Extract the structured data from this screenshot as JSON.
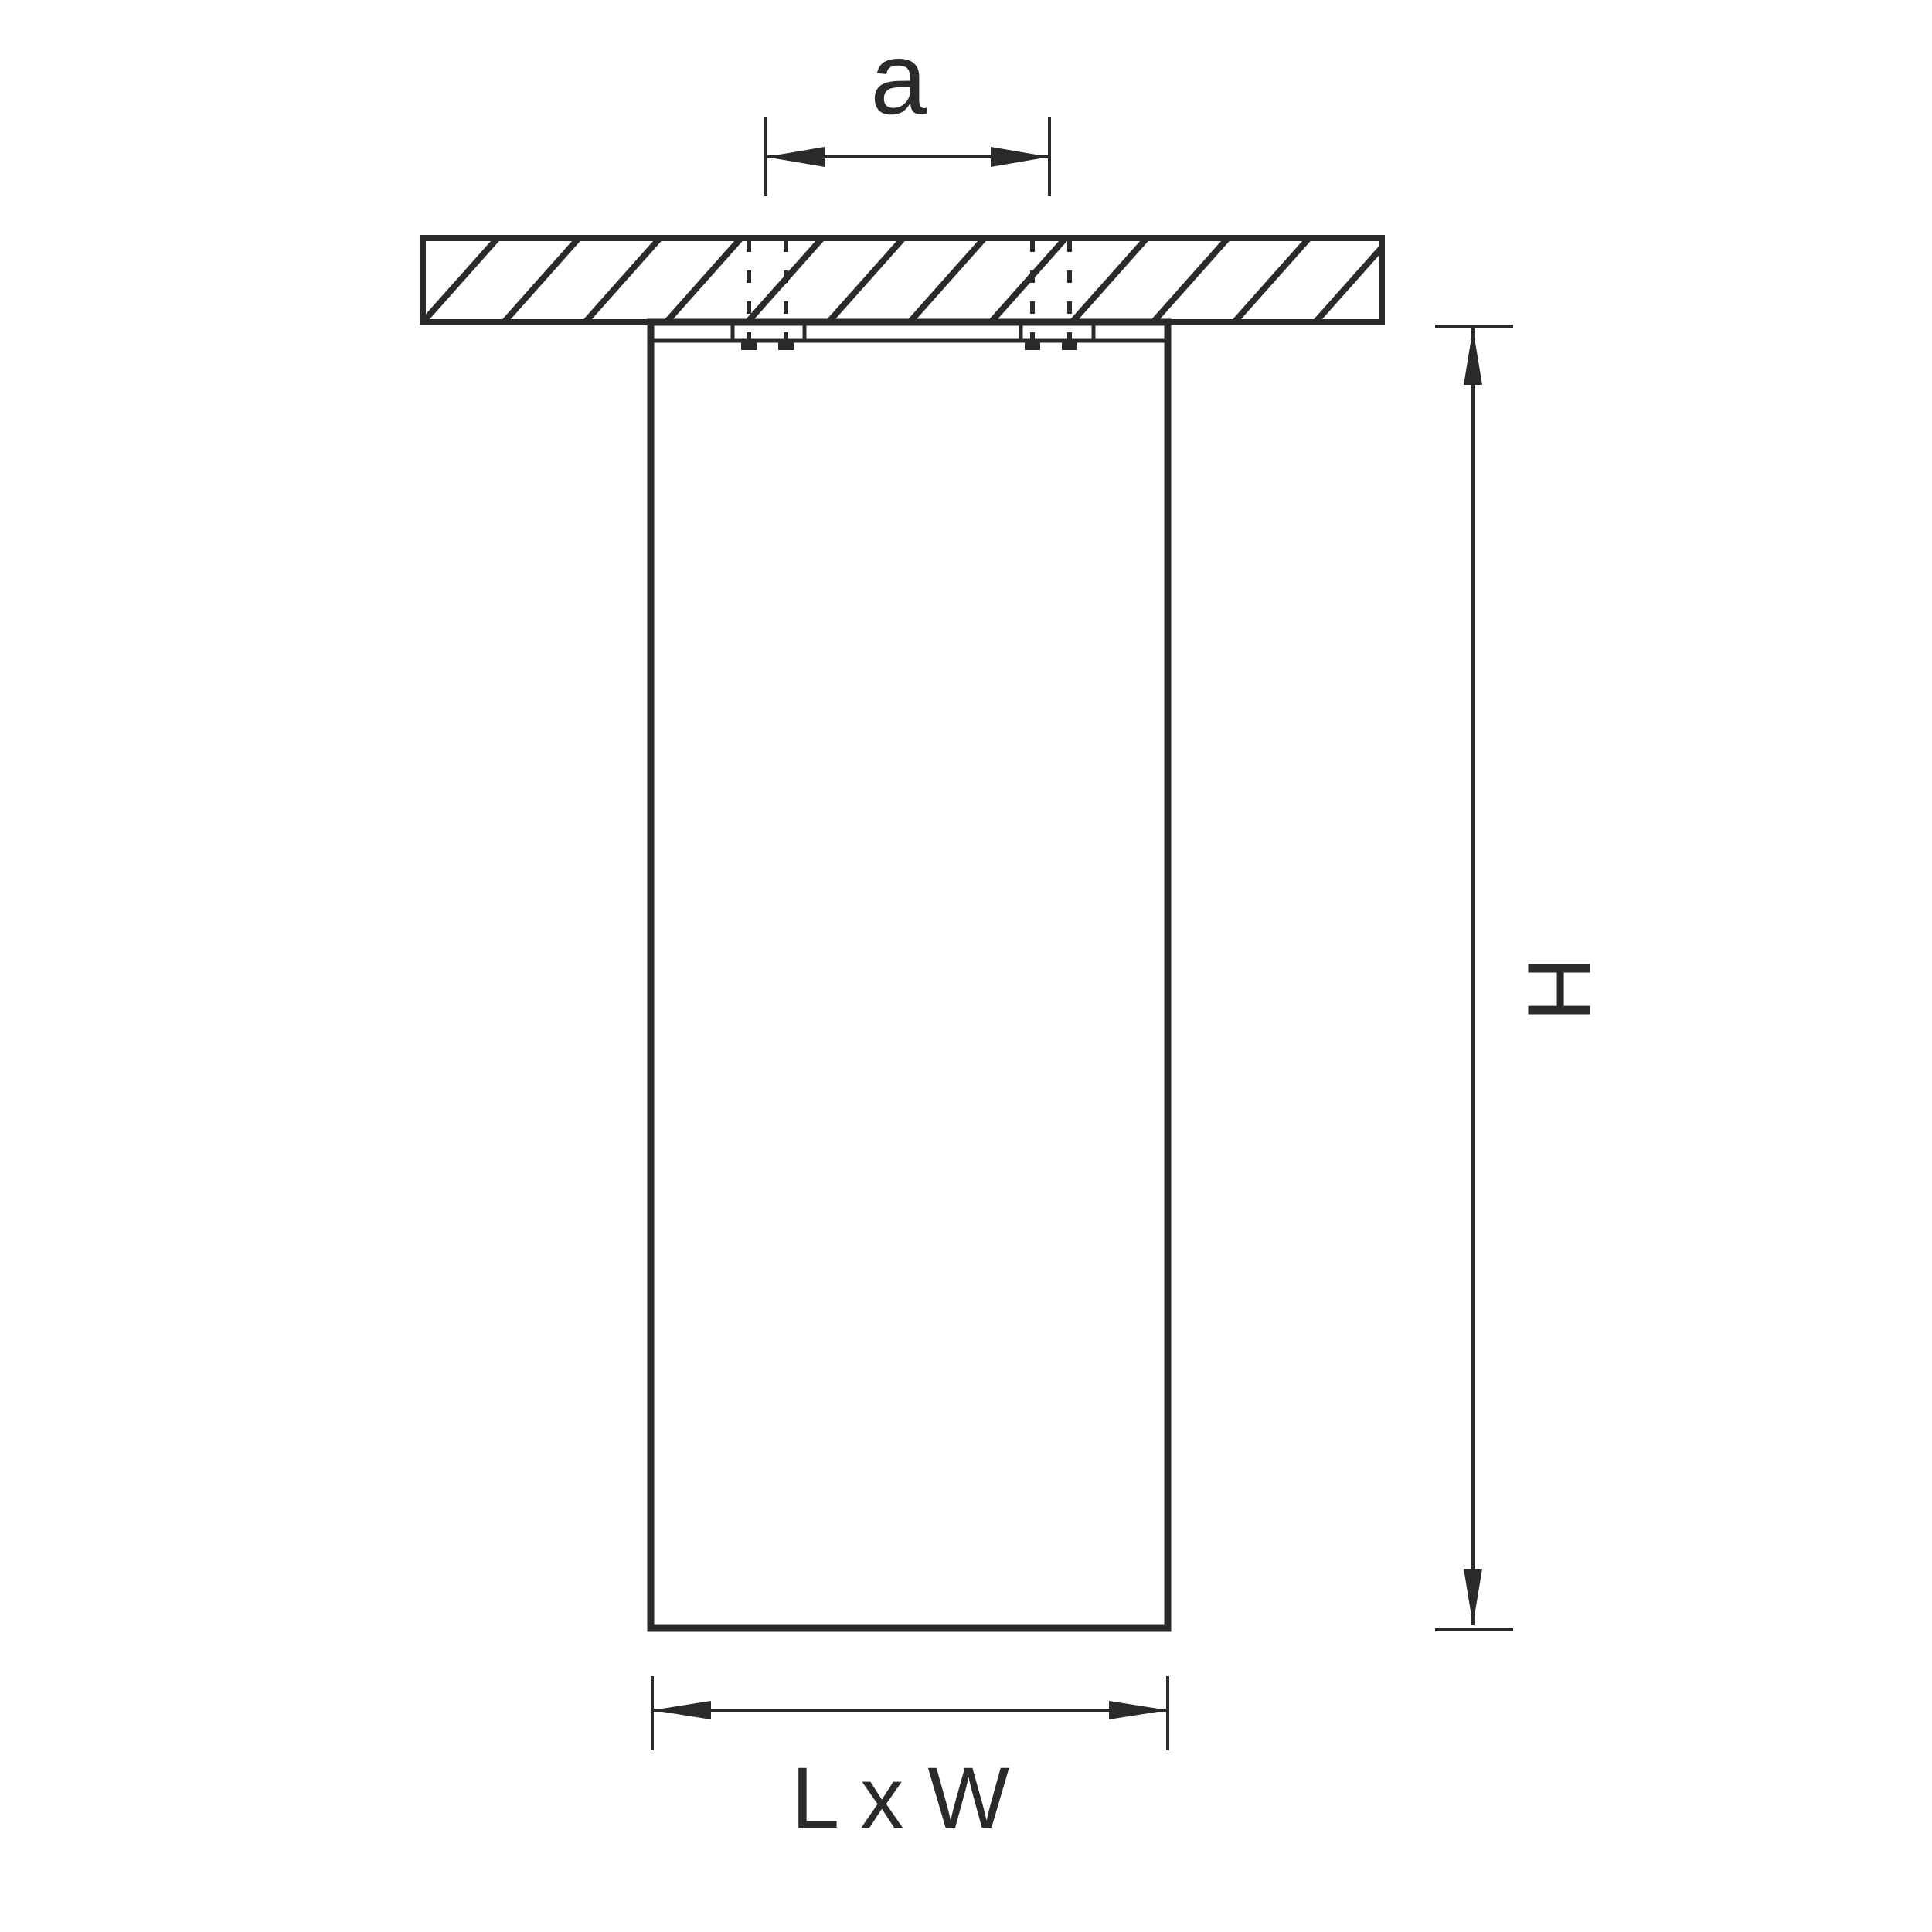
{
  "figure": {
    "labels": {
      "mount_spacing": "a",
      "height": "H",
      "footprint": "L x W"
    },
    "colors": {
      "line": "#2b2a29",
      "background": "#ffffff"
    }
  }
}
